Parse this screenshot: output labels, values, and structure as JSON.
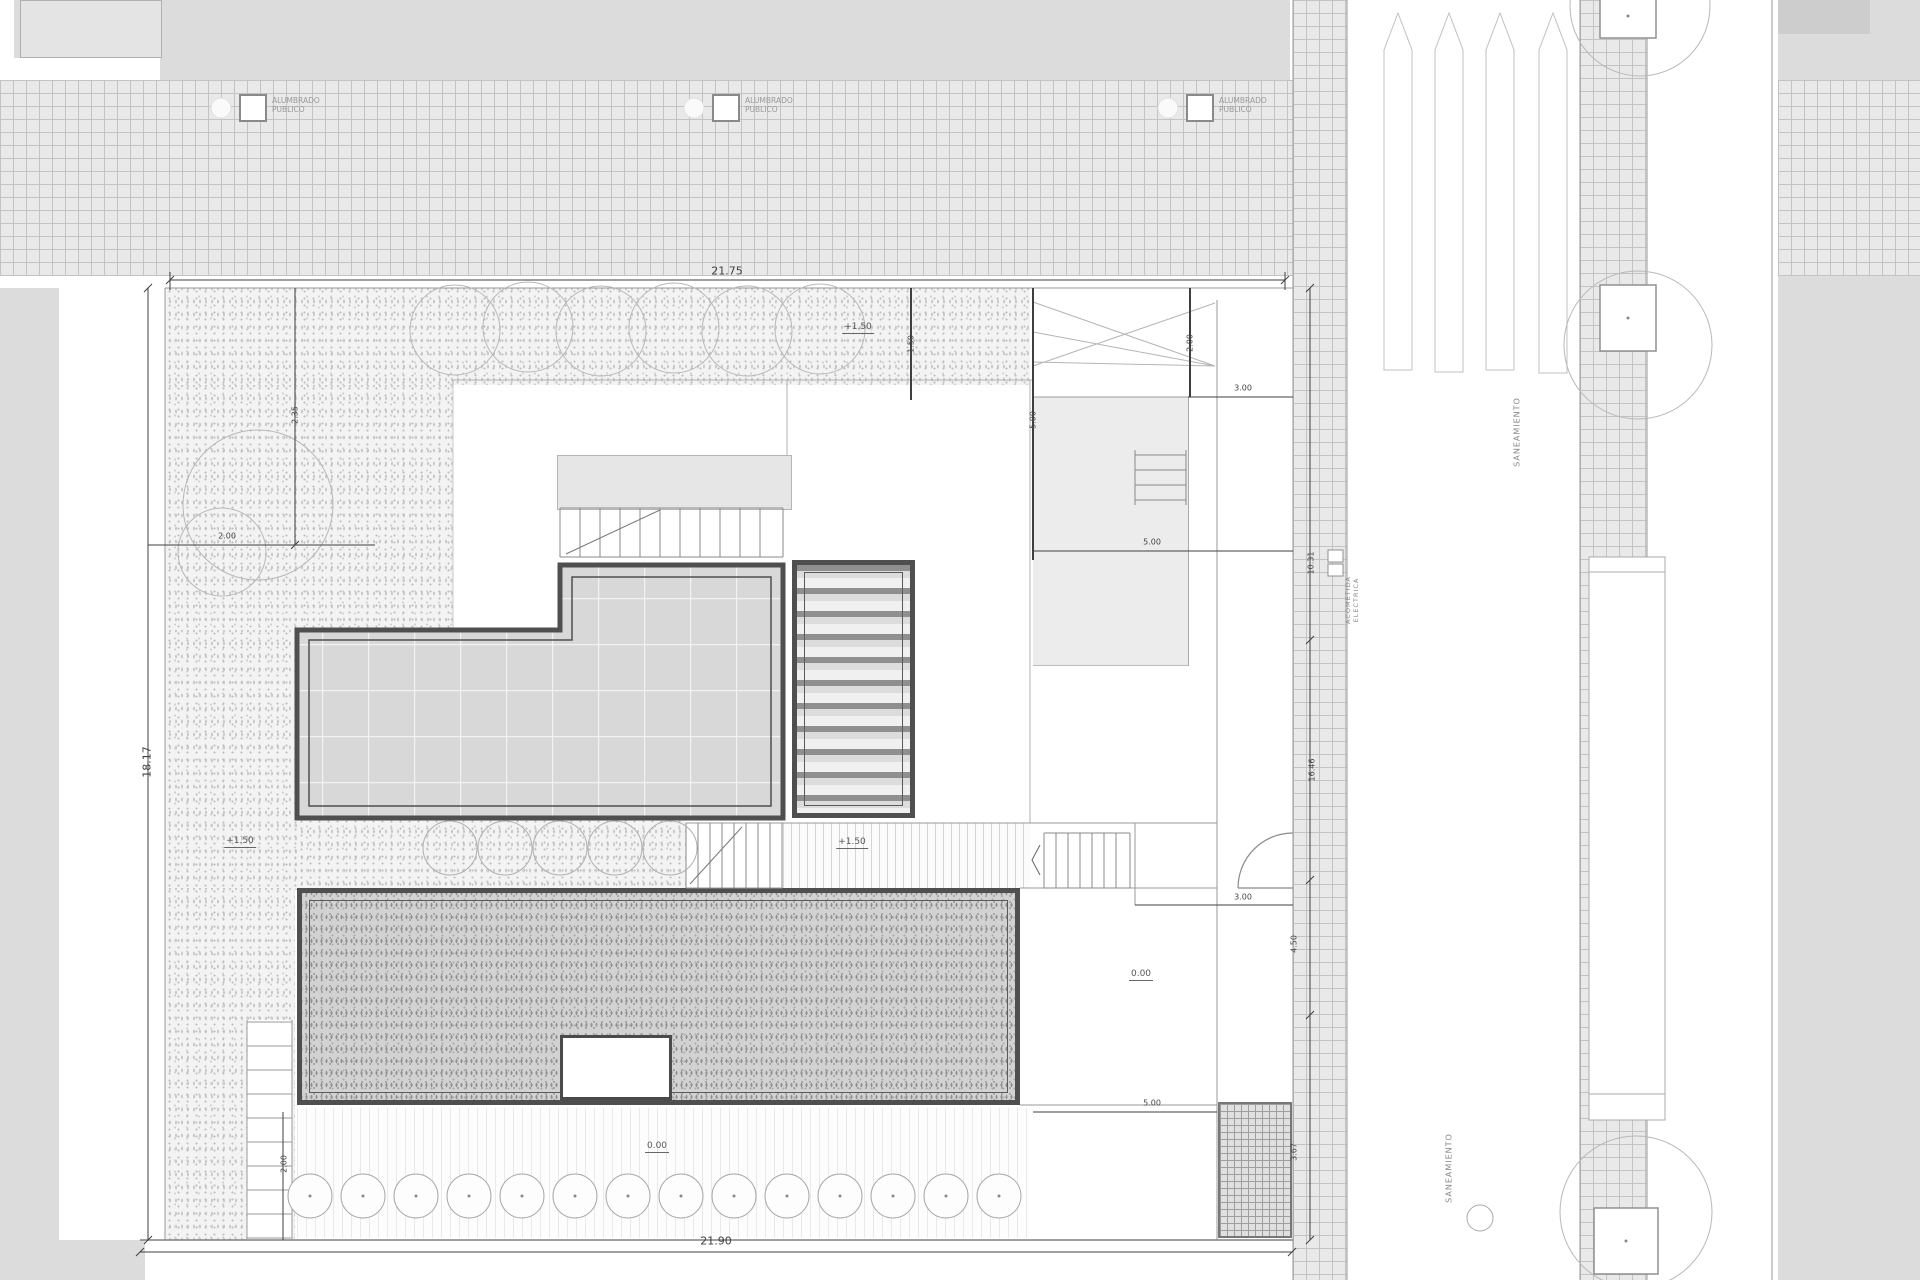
{
  "lamps": {
    "line1": "ALUMBRADO",
    "line2": "PUBLICO"
  },
  "dimensions": {
    "top": "21.75",
    "bottom": "21.90",
    "left": "18.17",
    "right1": "10.31",
    "right2": "16.46",
    "right3": "4.50",
    "right4": "3.67",
    "s1": "2.00",
    "s2": "2.35",
    "s3": "1.50",
    "s4": "5.00",
    "s5": "2.00",
    "s6": "3.00",
    "s7": "5.00",
    "s8": "3.00",
    "s10": "5.00",
    "s11": "2.00"
  },
  "elevations": {
    "e1": "+1.50",
    "e2": "+1.50",
    "e3": "+1.50",
    "e4": "0.00",
    "e5": "0.00"
  },
  "notes": {
    "saneamiento_top": "SANEAMIENTO",
    "saneamiento_bottom": "SANEAMIENTO",
    "acometida_line1": "ACOMETIDA",
    "acometida_line2": "ELECTRICA"
  },
  "colors": {
    "heavy_border": "#4f4f4f",
    "hatch_line": "#c3c3c3",
    "dim_line": "#3f3f3f",
    "sidewalk_gray": "#dcdcdc"
  }
}
